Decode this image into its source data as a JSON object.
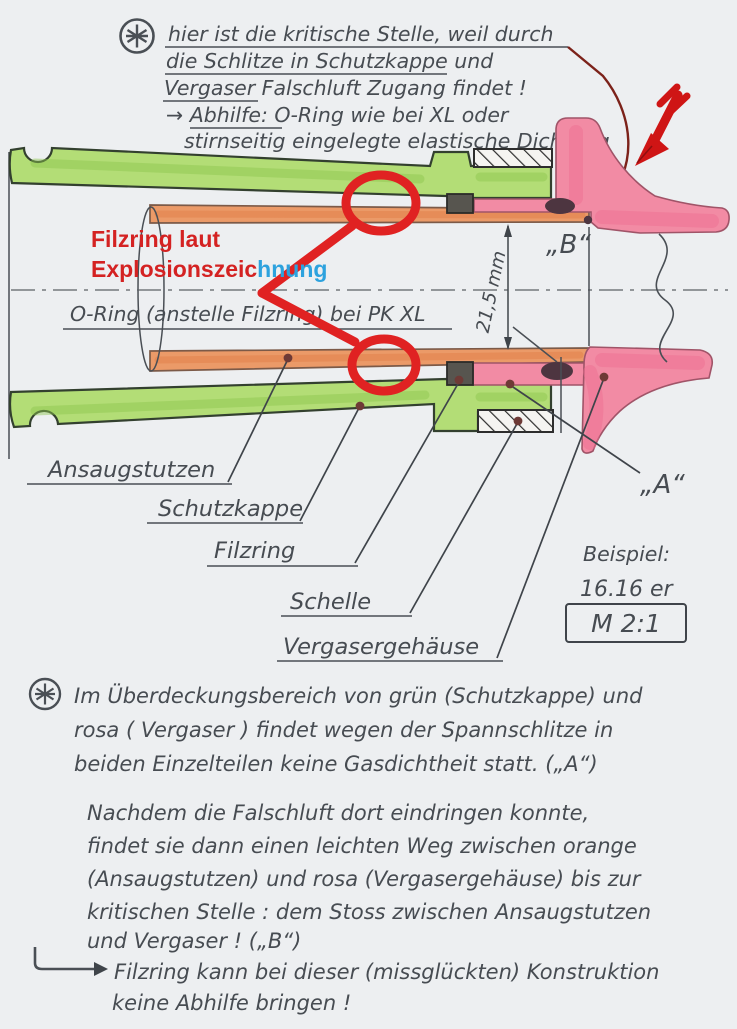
{
  "top_note": {
    "lines": [
      "hier ist die kritische Stelle, weil durch",
      "die Schlitze in Schutzkappe und",
      "Vergaser Falschluft Zugang findet !",
      "→ Abhilfe: O-Ring wie bei XL  oder",
      "stirnseitig eingelegte elastische Dichtung"
    ]
  },
  "red_note": {
    "line1": "Filzring laut",
    "line2_red": "Explosionszeic",
    "line2_blue": "hnung"
  },
  "diagram": {
    "bore_note": "O-Ring (anstelle Filzring) bei PK XL",
    "dimension_label": "21,5 mm",
    "point_b": "„B“",
    "point_a": "„A“",
    "part_labels": [
      "Ansaugstutzen",
      "Schutzkappe",
      "Filzring",
      "Schelle",
      "Vergasergehäuse"
    ],
    "example_line1": "Beispiel:",
    "example_line2": "16.16 er",
    "scale_label": "M 2:1"
  },
  "notes": {
    "para1_lines": [
      "Im Überdeckungsbereich von grün (Schutzkappe) und",
      "rosa ( Vergaser ) findet wegen der Spannschlitze in",
      "beiden Einzelteilen keine Gasdichtheit statt. („A“)"
    ],
    "para2_lines": [
      "Nachdem die Falschluft dort eindringen konnte,",
      "findet sie dann einen leichten Weg zwischen orange",
      "(Ansaugstutzen) und rosa (Vergasergehäuse) bis zur",
      "kritischen Stelle : dem Stoss zwischen Ansaugstutzen",
      "und Vergaser ! („B“)"
    ],
    "para3_lines": [
      "Filzring kann bei dieser (missglückten) Konstruktion",
      "keine Abhilfe bringen !"
    ]
  },
  "colors": {
    "cap_green": "#b3dd76",
    "intake_orange": "#eb9a68",
    "carburetor_pink": "#f28ba4",
    "felt_grey": "#57554f",
    "overlay_red": "#e02222",
    "overlay_blue": "#2da2de",
    "arrow_red": "#cf1515",
    "pencil_grey": "#4a4e54",
    "paper": "#edeff1"
  }
}
